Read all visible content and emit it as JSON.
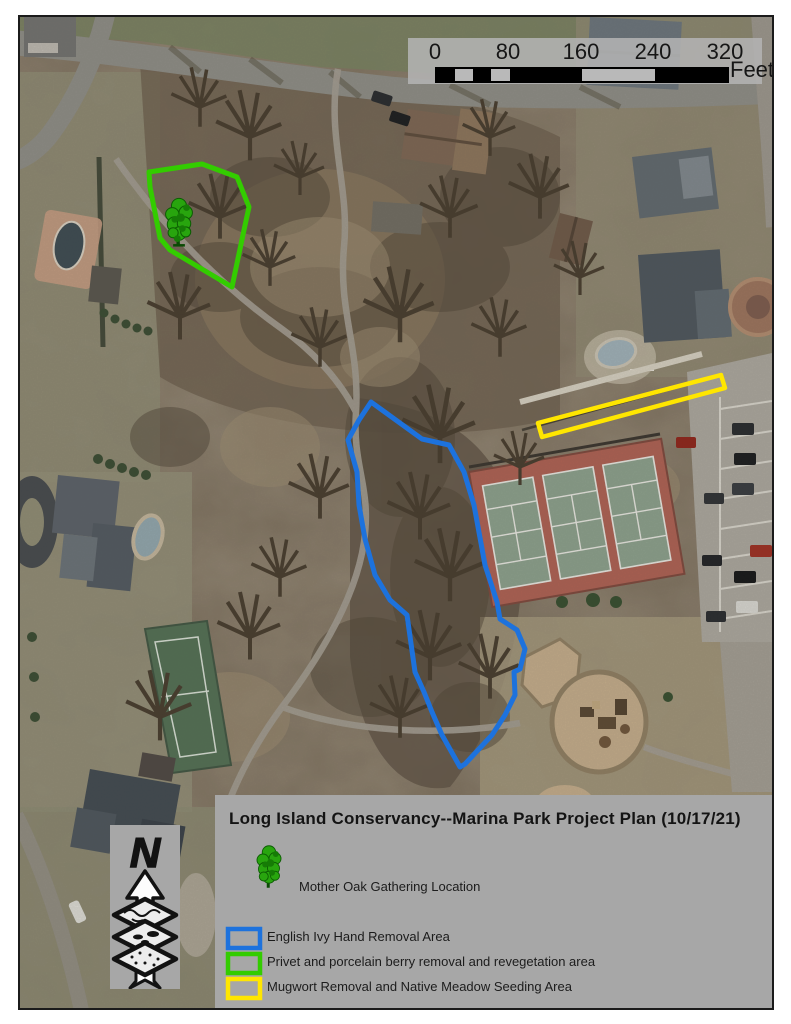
{
  "map": {
    "scale_bar": {
      "ticks": [
        "0",
        "80",
        "160",
        "240",
        "320"
      ],
      "unit": "Feet"
    },
    "north_arrow": {
      "label": "N"
    },
    "overlays": {
      "english_ivy": {
        "color": "#1d72dd"
      },
      "privet": {
        "color": "#33cc00"
      },
      "mugwort": {
        "color": "#ffe600"
      }
    },
    "legend": {
      "title": "Long Island Conservancy--Marina Park Project Plan (10/17/21)",
      "oak_item": {
        "label": "Mother Oak Gathering Location"
      },
      "items": [
        {
          "label": "English Ivy Hand Removal Area",
          "color": "#1d72dd"
        },
        {
          "label": "Privet and porcelain berry removal and revegetation area",
          "color": "#33cc00"
        },
        {
          "label": "Mugwort Removal and Native Meadow Seeding Area",
          "color": "#ffe600"
        }
      ]
    }
  }
}
